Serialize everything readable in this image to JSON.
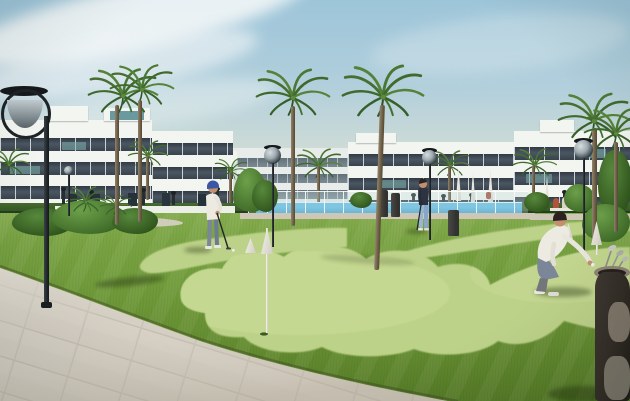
{
  "meta": {
    "title": "New-build residential complex with putting green",
    "description": "Architectural render: modern white apartment blocks with palm trees and a pool behind glass fencing; three people on a putting green with white cone flags, a paved walkway in the foreground and a golf bag at the right edge."
  },
  "colors": {
    "sky_top": "#9dc5d9",
    "sky_mid": "#cfdcd6",
    "sky_horizon": "#e6e7d5",
    "wall": "#f3f5f1",
    "wall_far": "#e9edec",
    "band_dark": "#38424c",
    "band_far": "#788690",
    "hedge": "#2f4d23",
    "grass_back": "#85ad4f",
    "grass": "#6f9a3a",
    "grass_front": "#577d28",
    "green_light": "#bdd289",
    "green_hi": "#cfe09c",
    "walk_tile": "#d4cec3",
    "pool": "#3e9ccd",
    "deck": "#cfc7b6",
    "lamp": "#22272b",
    "metal": "#9fabb0",
    "trunk": "#6f614c",
    "flag": "#f2f1e9",
    "skin": "#c2906f",
    "shirt_white": "#edebe1",
    "pants_gray": "#7b8698",
    "pants_blue": "#9ab5cf",
    "top_dark": "#2d3340",
    "cap_blue": "#3a57a6",
    "bag": "#322c26",
    "bag_trim": "#8d8375",
    "shadow": "rgba(25,40,8,0.38)"
  },
  "scene": {
    "objects": [
      {
        "name": "apartment-building-left"
      },
      {
        "name": "apartment-building-center-far"
      },
      {
        "name": "apartment-building-center"
      },
      {
        "name": "apartment-building-right"
      },
      {
        "name": "swimming-pool"
      },
      {
        "name": "glass-pool-fence"
      },
      {
        "name": "palm-trees"
      },
      {
        "name": "street-lamps"
      },
      {
        "name": "putting-green"
      },
      {
        "name": "white-cone-flags"
      },
      {
        "name": "golfer-putting"
      },
      {
        "name": "golfer-standing"
      },
      {
        "name": "golfer-crouching"
      },
      {
        "name": "paved-walkway"
      },
      {
        "name": "golf-bag"
      }
    ]
  }
}
